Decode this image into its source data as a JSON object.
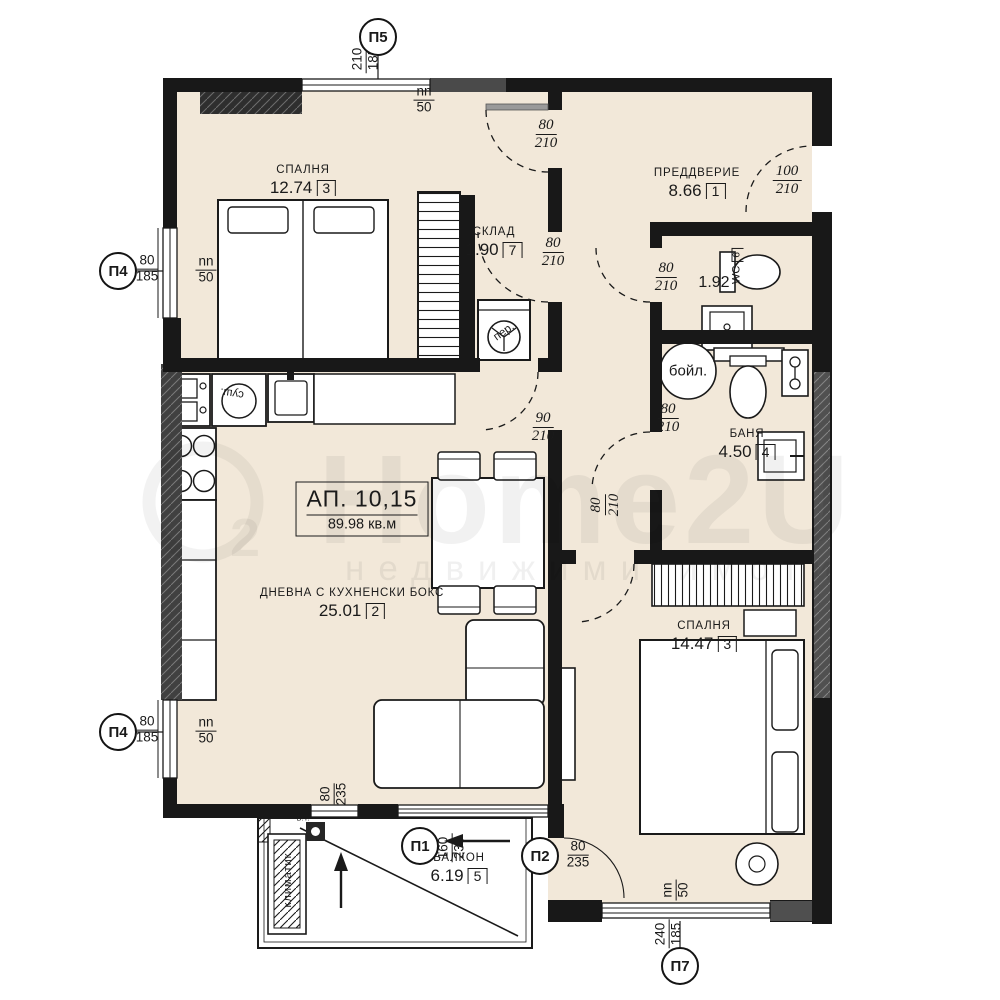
{
  "watermark": {
    "brand": "Home2U",
    "logo_sub": "2",
    "tagline": "недвижими имоти"
  },
  "apartment_box": {
    "line1": "АП. 10,15",
    "line2": "89.98 кв.м"
  },
  "rooms": {
    "bedroom1": {
      "name": "СПАЛНЯ",
      "area": "12.74",
      "index": "3"
    },
    "entry": {
      "name": "ПРЕДДВЕРИЕ",
      "area": "8.66",
      "index": "1"
    },
    "storage": {
      "name": "СКЛАД",
      "area": "1.90",
      "index": "7"
    },
    "wc": {
      "name": "WC",
      "area": "1.92",
      "index": "6"
    },
    "bath": {
      "name": "БАНЯ",
      "area": "4.50",
      "index": "4"
    },
    "living": {
      "name": "ДНЕВНА С КУХНЕНСКИ БОКС",
      "area": "25.01",
      "index": "2"
    },
    "bedroom2": {
      "name": "СПАЛНЯ",
      "area": "14.47",
      "index": "3"
    },
    "balcony": {
      "name": "БАЛКОН",
      "area": "6.19",
      "index": "5"
    }
  },
  "markers": {
    "p5": {
      "label": "П5",
      "top": "210",
      "bottom": "185"
    },
    "p4a": {
      "label": "П4",
      "top": "80",
      "bottom": "185"
    },
    "p4b": {
      "label": "П4",
      "top": "80",
      "bottom": "185"
    },
    "p1": {
      "label": "П1",
      "top": "160",
      "bottom": "235"
    },
    "p2": {
      "label": "П2",
      "top": "80",
      "bottom": "235"
    },
    "p7": {
      "label": "П7",
      "top": "240",
      "bottom": "185"
    }
  },
  "door_dims": {
    "bedroom1": {
      "top": "80",
      "bottom": "210"
    },
    "entrance": {
      "top": "100",
      "bottom": "210"
    },
    "storage": {
      "top": "80",
      "bottom": "210"
    },
    "wc": {
      "top": "80",
      "bottom": "210"
    },
    "living": {
      "top": "90",
      "bottom": "210"
    },
    "bath": {
      "top": "80",
      "bottom": "210"
    },
    "bedroom2": {
      "top": "80",
      "bottom": "210"
    }
  },
  "window_dims": {
    "top": {
      "top": "nn",
      "bottom": "50"
    },
    "left1": {
      "top": "nn",
      "bottom": "50"
    },
    "left2": {
      "top": "nn",
      "bottom": "50"
    },
    "bottom": {
      "top": "nn",
      "bottom": "50"
    },
    "french": {
      "top": "80",
      "bottom": "235"
    }
  },
  "equipment": {
    "boiler": "бойл.",
    "washer": "пер.",
    "dryer": "суш.",
    "ac": "климатик",
    "vt": "В.Т."
  }
}
